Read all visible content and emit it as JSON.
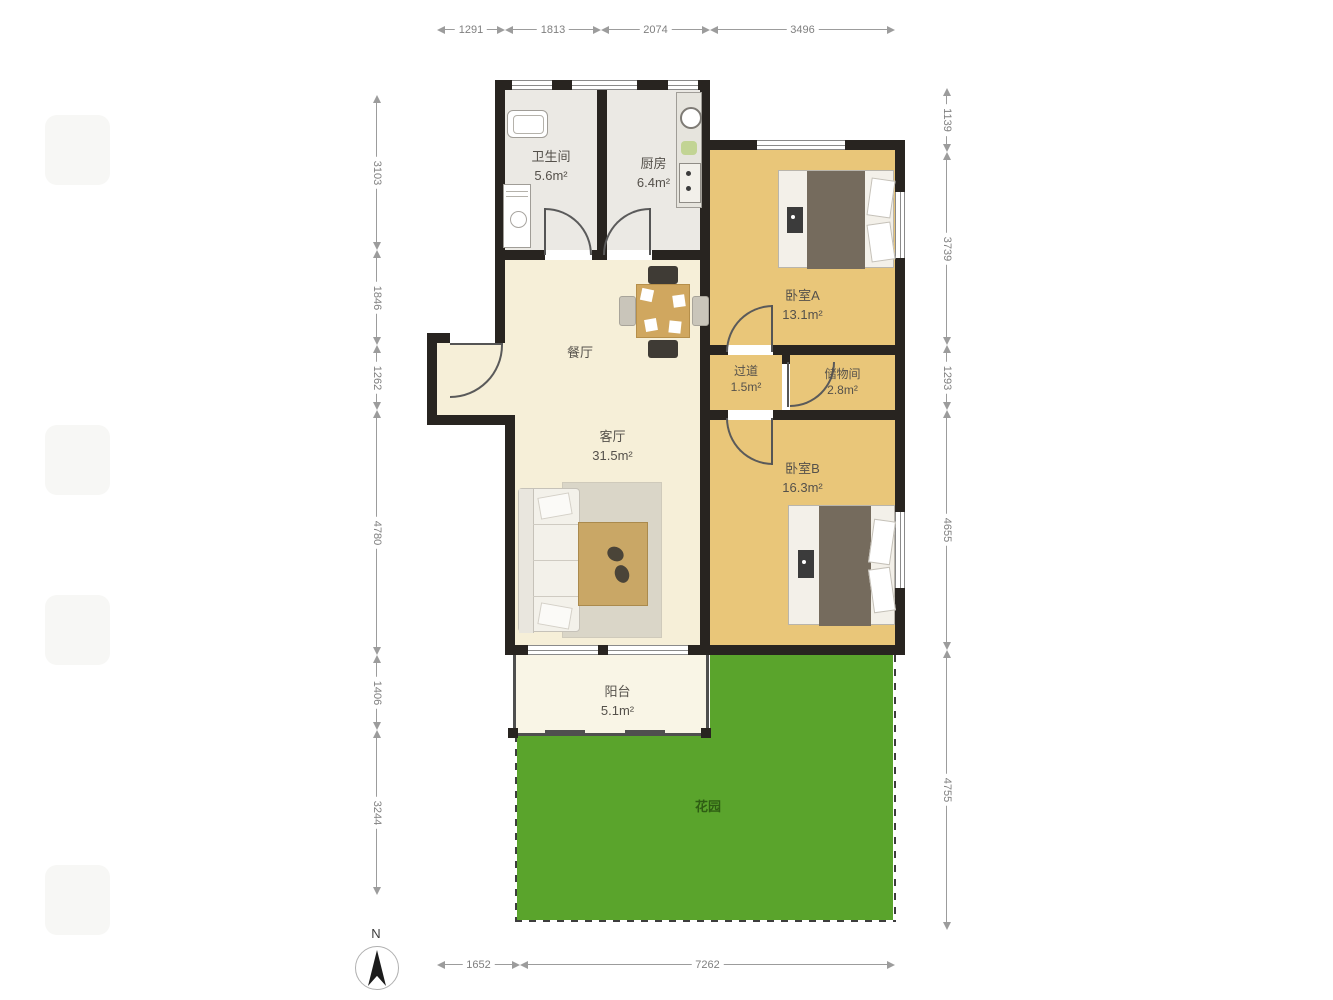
{
  "plan": {
    "title": "apartment-floor-plan",
    "rooms": [
      {
        "id": "bathroom",
        "name": "卫生间",
        "area": "5.6m²"
      },
      {
        "id": "kitchen",
        "name": "厨房",
        "area": "6.4m²"
      },
      {
        "id": "bedroom-a",
        "name": "卧室A",
        "area": "13.1m²"
      },
      {
        "id": "dining",
        "name": "餐厅",
        "area": ""
      },
      {
        "id": "hallway",
        "name": "过道",
        "area": "1.5m²"
      },
      {
        "id": "storage",
        "name": "储物间",
        "area": "2.8m²"
      },
      {
        "id": "living",
        "name": "客厅",
        "area": "31.5m²"
      },
      {
        "id": "bedroom-b",
        "name": "卧室B",
        "area": "16.3m²"
      },
      {
        "id": "balcony",
        "name": "阳台",
        "area": "5.1m²"
      },
      {
        "id": "garden",
        "name": "花园",
        "area": ""
      }
    ],
    "dimensions": {
      "top": [
        "1291",
        "1813",
        "2074",
        "3496"
      ],
      "bottom": [
        "1652",
        "7262"
      ],
      "left": [
        "3103",
        "1846",
        "1262",
        "4780",
        "1406",
        "3244"
      ],
      "right": [
        "1139",
        "3739",
        "1293",
        "4655",
        "4755"
      ]
    },
    "compass": {
      "label": "N"
    },
    "colors": {
      "wall": "#282420",
      "floor_cream": "#f6efd8",
      "floor_tan": "#e9c679",
      "floor_gray": "#ebe9e4",
      "balcony": "#f9f5e6",
      "garden_green": "#5aa42c",
      "garden_text": "#2e5d13",
      "dimension_text": "#7f7f7f"
    }
  }
}
